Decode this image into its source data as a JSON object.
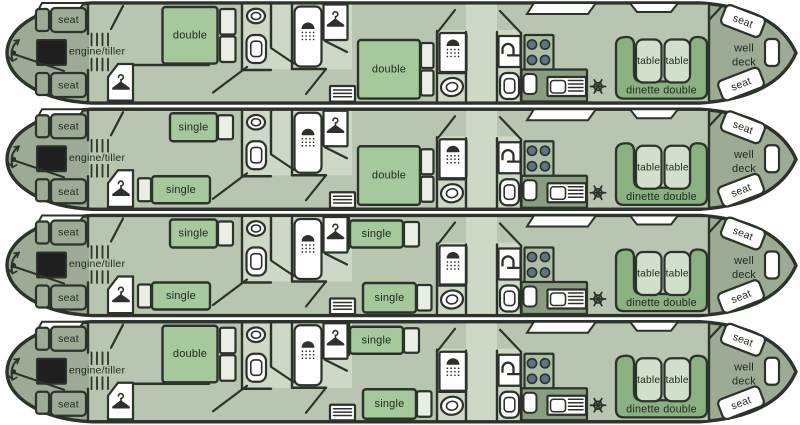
{
  "palette": {
    "line": "#2b332a",
    "deck": "#9dab96",
    "floor": "#b8c6b1",
    "floor_light": "#cdd8c6",
    "bed": "#a6c89d",
    "cupboard": "#e9efe5",
    "bench": "#8bb081",
    "table": "#d2dfcc",
    "counter": "#8a9d81",
    "stove_panel": "#aebda8",
    "burner": "#5f7480",
    "engine": "#1f1f1f",
    "fixture": "#ffffff",
    "text": "#202a20"
  },
  "icons": {
    "wardrobe": "hanger-icon",
    "shower": "shower-icon",
    "wc": "toilet-icon",
    "washbasin": "basin-icon",
    "vanity": "tap-icon",
    "fridge": "snowflake-icon",
    "hob": "stove-burners-icon",
    "steering": "tiller-arrow-icon"
  },
  "boats": [
    {
      "stern": {
        "seat_top": "seat",
        "seat_bottom": "seat",
        "engine_tiller_label": "engine/tiller"
      },
      "aft_cabin": {
        "layout": "double",
        "bed_labels": [
          "double"
        ]
      },
      "mid_cabin": {
        "layout": "double",
        "bed_labels": [
          "double"
        ]
      },
      "dinette": {
        "label": "dinette double",
        "table_labels": [
          "table",
          "table"
        ]
      },
      "bow": {
        "well_deck_lines": [
          "well",
          "deck"
        ],
        "seat_top": "seat",
        "seat_bottom": "seat"
      }
    },
    {
      "stern": {
        "seat_top": "seat",
        "seat_bottom": "seat",
        "engine_tiller_label": "engine/tiller"
      },
      "aft_cabin": {
        "layout": "twin",
        "bed_labels": [
          "single",
          "single"
        ]
      },
      "mid_cabin": {
        "layout": "double",
        "bed_labels": [
          "double"
        ]
      },
      "dinette": {
        "label": "dinette double",
        "table_labels": [
          "table",
          "table"
        ]
      },
      "bow": {
        "well_deck_lines": [
          "well",
          "deck"
        ],
        "seat_top": "seat",
        "seat_bottom": "seat"
      }
    },
    {
      "stern": {
        "seat_top": "seat",
        "seat_bottom": "seat",
        "engine_tiller_label": "engine/tiller"
      },
      "aft_cabin": {
        "layout": "twin",
        "bed_labels": [
          "single",
          "single"
        ]
      },
      "mid_cabin": {
        "layout": "twin",
        "bed_labels": [
          "single",
          "single"
        ]
      },
      "dinette": {
        "label": "dinette double",
        "table_labels": [
          "table",
          "table"
        ]
      },
      "bow": {
        "well_deck_lines": [
          "well",
          "deck"
        ],
        "seat_top": "seat",
        "seat_bottom": "seat"
      }
    },
    {
      "stern": {
        "seat_top": "seat",
        "seat_bottom": "seat",
        "engine_tiller_label": "engine/tiller"
      },
      "aft_cabin": {
        "layout": "double",
        "bed_labels": [
          "double"
        ]
      },
      "mid_cabin": {
        "layout": "twin",
        "bed_labels": [
          "single",
          "single"
        ]
      },
      "dinette": {
        "label": "dinette double",
        "table_labels": [
          "table",
          "table"
        ]
      },
      "bow": {
        "well_deck_lines": [
          "well",
          "deck"
        ],
        "seat_top": "seat",
        "seat_bottom": "seat"
      }
    }
  ]
}
